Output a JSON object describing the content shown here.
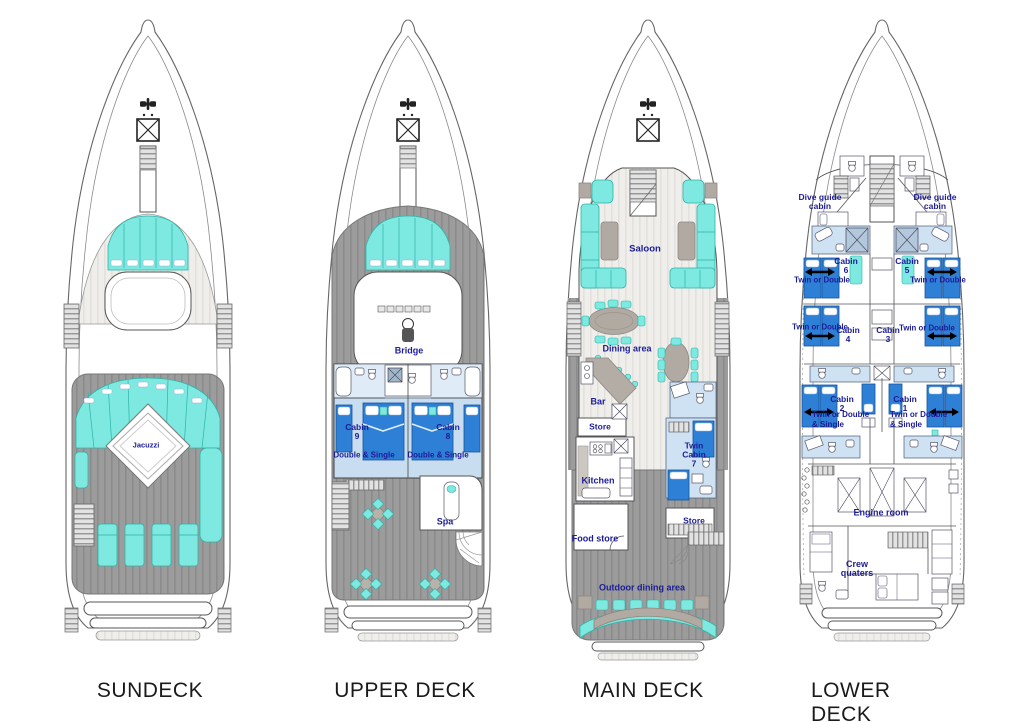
{
  "page": {
    "background": "#ffffff"
  },
  "palette": {
    "accent_cyan": "#7de9e0",
    "bed_blue": "#2e7fd6",
    "bath_blue": "#cfe2f3",
    "deck_gray": "#9b9b9b",
    "label_navy": "#1c1c96",
    "title_color": "#1a1a1a"
  },
  "decks": {
    "sundeck": {
      "title": "SUNDECK",
      "rooms": {
        "jacuzzi": "Jacuzzi"
      }
    },
    "upper": {
      "title": "UPPER DECK",
      "rooms": {
        "bridge": "Bridge",
        "cabin9_name": "Cabin\n9",
        "cabin9_type": "Double & Single",
        "cabin8_name": "Cabin\n8",
        "cabin8_type": "Double & Single",
        "spa": "Spa"
      }
    },
    "main": {
      "title": "MAIN DECK",
      "rooms": {
        "saloon": "Saloon",
        "dining_area": "Dining area",
        "bar": "Bar",
        "store_forward": "Store",
        "kitchen": "Kitchen",
        "twin_cabin7": "Twin\nCabin\n7",
        "food_store": "Food store",
        "store_aft": "Store",
        "outdoor_dining": "Outdoor dining area"
      }
    },
    "lower": {
      "title": "LOWER DECK",
      "rooms": {
        "dive_guide_port": "Dive guide\ncabin",
        "dive_guide_starboard": "Dive guide\ncabin",
        "cabin6_name": "Cabin\n6",
        "cabin6_type": "Twin or Double",
        "cabin5_name": "Cabin\n5",
        "cabin5_type": "Twin or Double",
        "cabin4_name": "Cabin\n4",
        "cabin4_type": "Twin or Double",
        "cabin3_name": "Cabin\n3",
        "cabin3_type": "Twin or Double",
        "cabin2_name": "Cabin\n2",
        "cabin2_type": "Twin or Double\n& Single",
        "cabin1_name": "Cabin\n1",
        "cabin1_type": "Twin or Double\n& Single",
        "engine_room": "Engine room",
        "crew_quarters": "Crew\nquaters"
      }
    }
  }
}
